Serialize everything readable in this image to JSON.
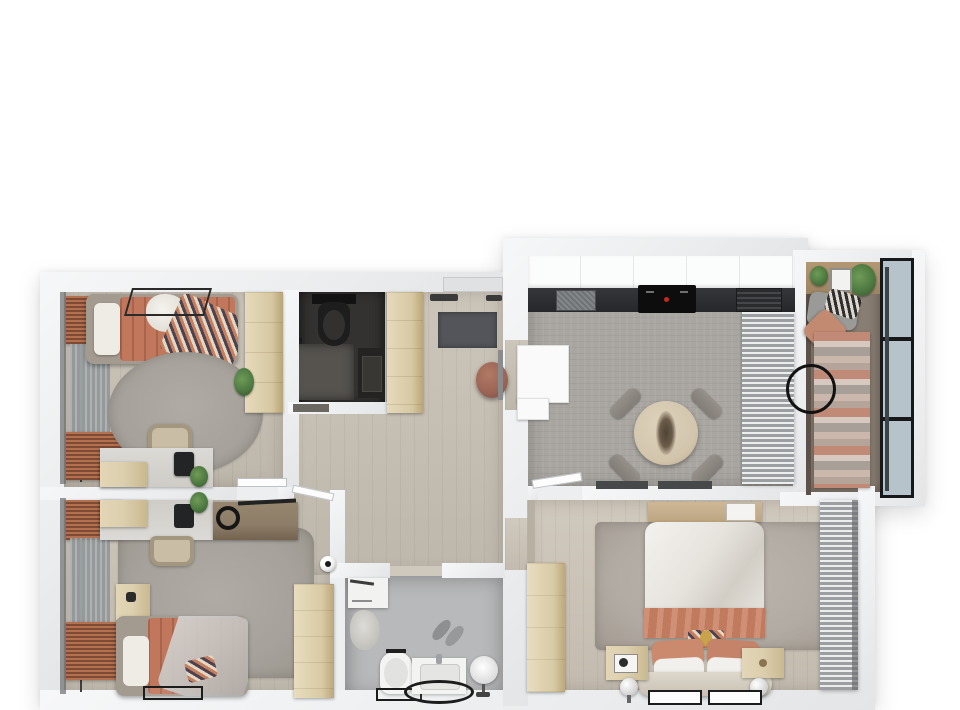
{
  "meta": {
    "content": "photoreal top-down 3D render of an apartment floor plan",
    "view": "top-down orthographic",
    "canvas_px": {
      "width": 960,
      "height": 710
    },
    "visible_text": "none"
  },
  "palette": {
    "background": "#ffffff",
    "wall": "#eceeef",
    "wood_floor": "#c8c1b5",
    "kitchen_floor": "#a9a6a1",
    "bathroom_floor": "#b8b9ba",
    "wc_dark": "#343230",
    "balcony_floor": "#897e73",
    "rug_gray": "#a6a19b",
    "master_rug": "#b2aba3",
    "coral_accent": "#c0775c",
    "terracotta_curtain": "#9b5d41",
    "light_wood_furniture": "#dccfae",
    "mid_wood": "#b99e79",
    "dark_wood_desk": "#8d7c67",
    "counter_dark": "#2c2d2f",
    "appliance_black": "#121214",
    "white_furniture": "#fafafa",
    "window_glass": "#b7c3cb",
    "window_frame": "#16181a",
    "plant_green": "#4e7a42",
    "chair_beige": "#c9bda6",
    "dining_chair_gray": "#8f8984",
    "curtain_silver": "#9c9fa2",
    "pouf_leather": "#9b6353",
    "doormat": "#54555a"
  },
  "rooms": [
    {
      "id": "bedroom-1",
      "position": "top-left",
      "floor": "wood",
      "furniture": [
        "single-bed-coral-bedding",
        "canopy-frame",
        "white-pillow",
        "patterned-throw",
        "round-gray-rug",
        "tall-wardrobe",
        "desk-with-monitor",
        "desk-chair",
        "potted-plant",
        "coral-window-curtains",
        "sheer-blind"
      ]
    },
    {
      "id": "bedroom-2",
      "position": "bottom-left",
      "floor": "wood",
      "furniture": [
        "single-bed-coral-bedding",
        "gray-throw-blanket",
        "nightstand",
        "gray-rug",
        "desk-with-monitor",
        "dark-wood-side-desk",
        "headphones",
        "desk-chair",
        "wardrobe",
        "soccer-ball",
        "black-floor-mat",
        "coral-window-curtains"
      ]
    },
    {
      "id": "wc",
      "position": "center-top",
      "floor": "dark-charcoal",
      "furniture": [
        "toilet",
        "dark-washbasin-vanity"
      ]
    },
    {
      "id": "entry-hall",
      "position": "center",
      "floor": "wood",
      "furniture": [
        "entrance-door",
        "dark-doormat",
        "leather-pouf",
        "tall-wardrobe",
        "wall-hooks"
      ]
    },
    {
      "id": "hallway",
      "position": "center",
      "floor": "wood",
      "furniture": [
        "door-leaves"
      ]
    },
    {
      "id": "bathroom",
      "position": "bottom-center",
      "floor": "gray-tile",
      "furniture": [
        "washer-cabinet",
        "towels",
        "toilet",
        "vanity-sink",
        "oval-black-mat",
        "rect-black-mat",
        "slippers",
        "round-standing-mirror"
      ]
    },
    {
      "id": "kitchen-dining",
      "position": "top-right",
      "floor": "gray-tile",
      "furniture": [
        "upper-cabinet-run",
        "dark-countertop",
        "sink",
        "black-cooktop",
        "built-in-appliance",
        "white-l-counter",
        "round-dining-table",
        "dining-chairs-x4",
        "table-centerpiece",
        "sheer-silver-curtains",
        "door-mats-x2"
      ]
    },
    {
      "id": "balcony",
      "position": "far-right-top",
      "floor": "dark-wood",
      "furniture": [
        "plant-shelf",
        "picture-frame",
        "plants",
        "daybed-cushions",
        "coral-pillow",
        "striped-runner-rug",
        "black-wire-table",
        "glazed-window-wall"
      ]
    },
    {
      "id": "master-bedroom",
      "position": "bottom-right",
      "floor": "wood",
      "furniture": [
        "double-bed-white-duvet",
        "coral-throw-band",
        "coral-pillows-x2",
        "white-pillows-x2",
        "patterned-lumbar-pillow",
        "upholstered-headboard",
        "nightstands-x2",
        "sphere-table-lamps-x2",
        "large-gray-rug",
        "wall-shelf-panel",
        "white-wall-frame",
        "tall-wardrobe",
        "silver-sheer-curtains",
        "leaning-floor-frames-x2"
      ]
    }
  ],
  "counts": {
    "bedrooms": 3,
    "bathrooms": 2,
    "balconies": 1,
    "dining_chairs": 4,
    "table_lamps": 2
  }
}
